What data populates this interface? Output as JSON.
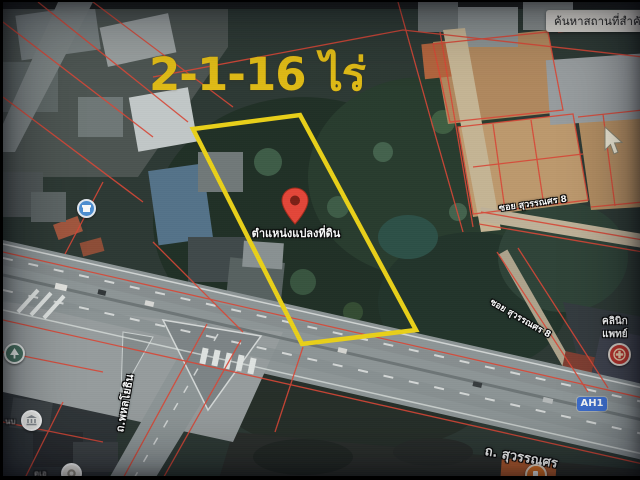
{
  "app": {
    "type": "satellite-map-photo"
  },
  "search": {
    "value": "ค้นหาสถานที่สำคั"
  },
  "annotations": {
    "area_label": "2-1-16 ไร่",
    "pin_label": "ตำแหน่งแปลงที่ดิน"
  },
  "roads": {
    "soi_upper": "ซอย สุวรรณศร 8",
    "soi_lower": "ซอย สุวรรณศร 8",
    "shield": "AH1",
    "main": "ถ. สุวรรณศร",
    "cross": "ถ.พหลโยธิน"
  },
  "pois": {
    "clinic_line1": "คลินิก",
    "clinic_line2": "แพทย์",
    "partial_left": "นบ",
    "partial_bottom": "ดเอ"
  },
  "icons": {
    "location-pin-icon": "red teardrop map pin",
    "store-poi-icon": "blue storefront marker",
    "park-poi-icon": "green tree marker",
    "bank-poi-icon": "white bank-building marker",
    "food-poi-icon": "white food marker",
    "gas-poi-icon": "orange station marker",
    "clinic-logo-icon": "red circular clinic logo",
    "mouse-cursor-icon": "arrow pointer"
  },
  "colors": {
    "plot_outline": "#f0d414",
    "area_text": "#e5bd10",
    "cadastral_line": "#dd4433",
    "pin_red": "#e94335",
    "pin_core": "#7c1b10",
    "shield_bg": "#3a6cd0",
    "search_bg": "#d8d5cf",
    "search_text": "#222222",
    "label_text": "#ffffff"
  }
}
